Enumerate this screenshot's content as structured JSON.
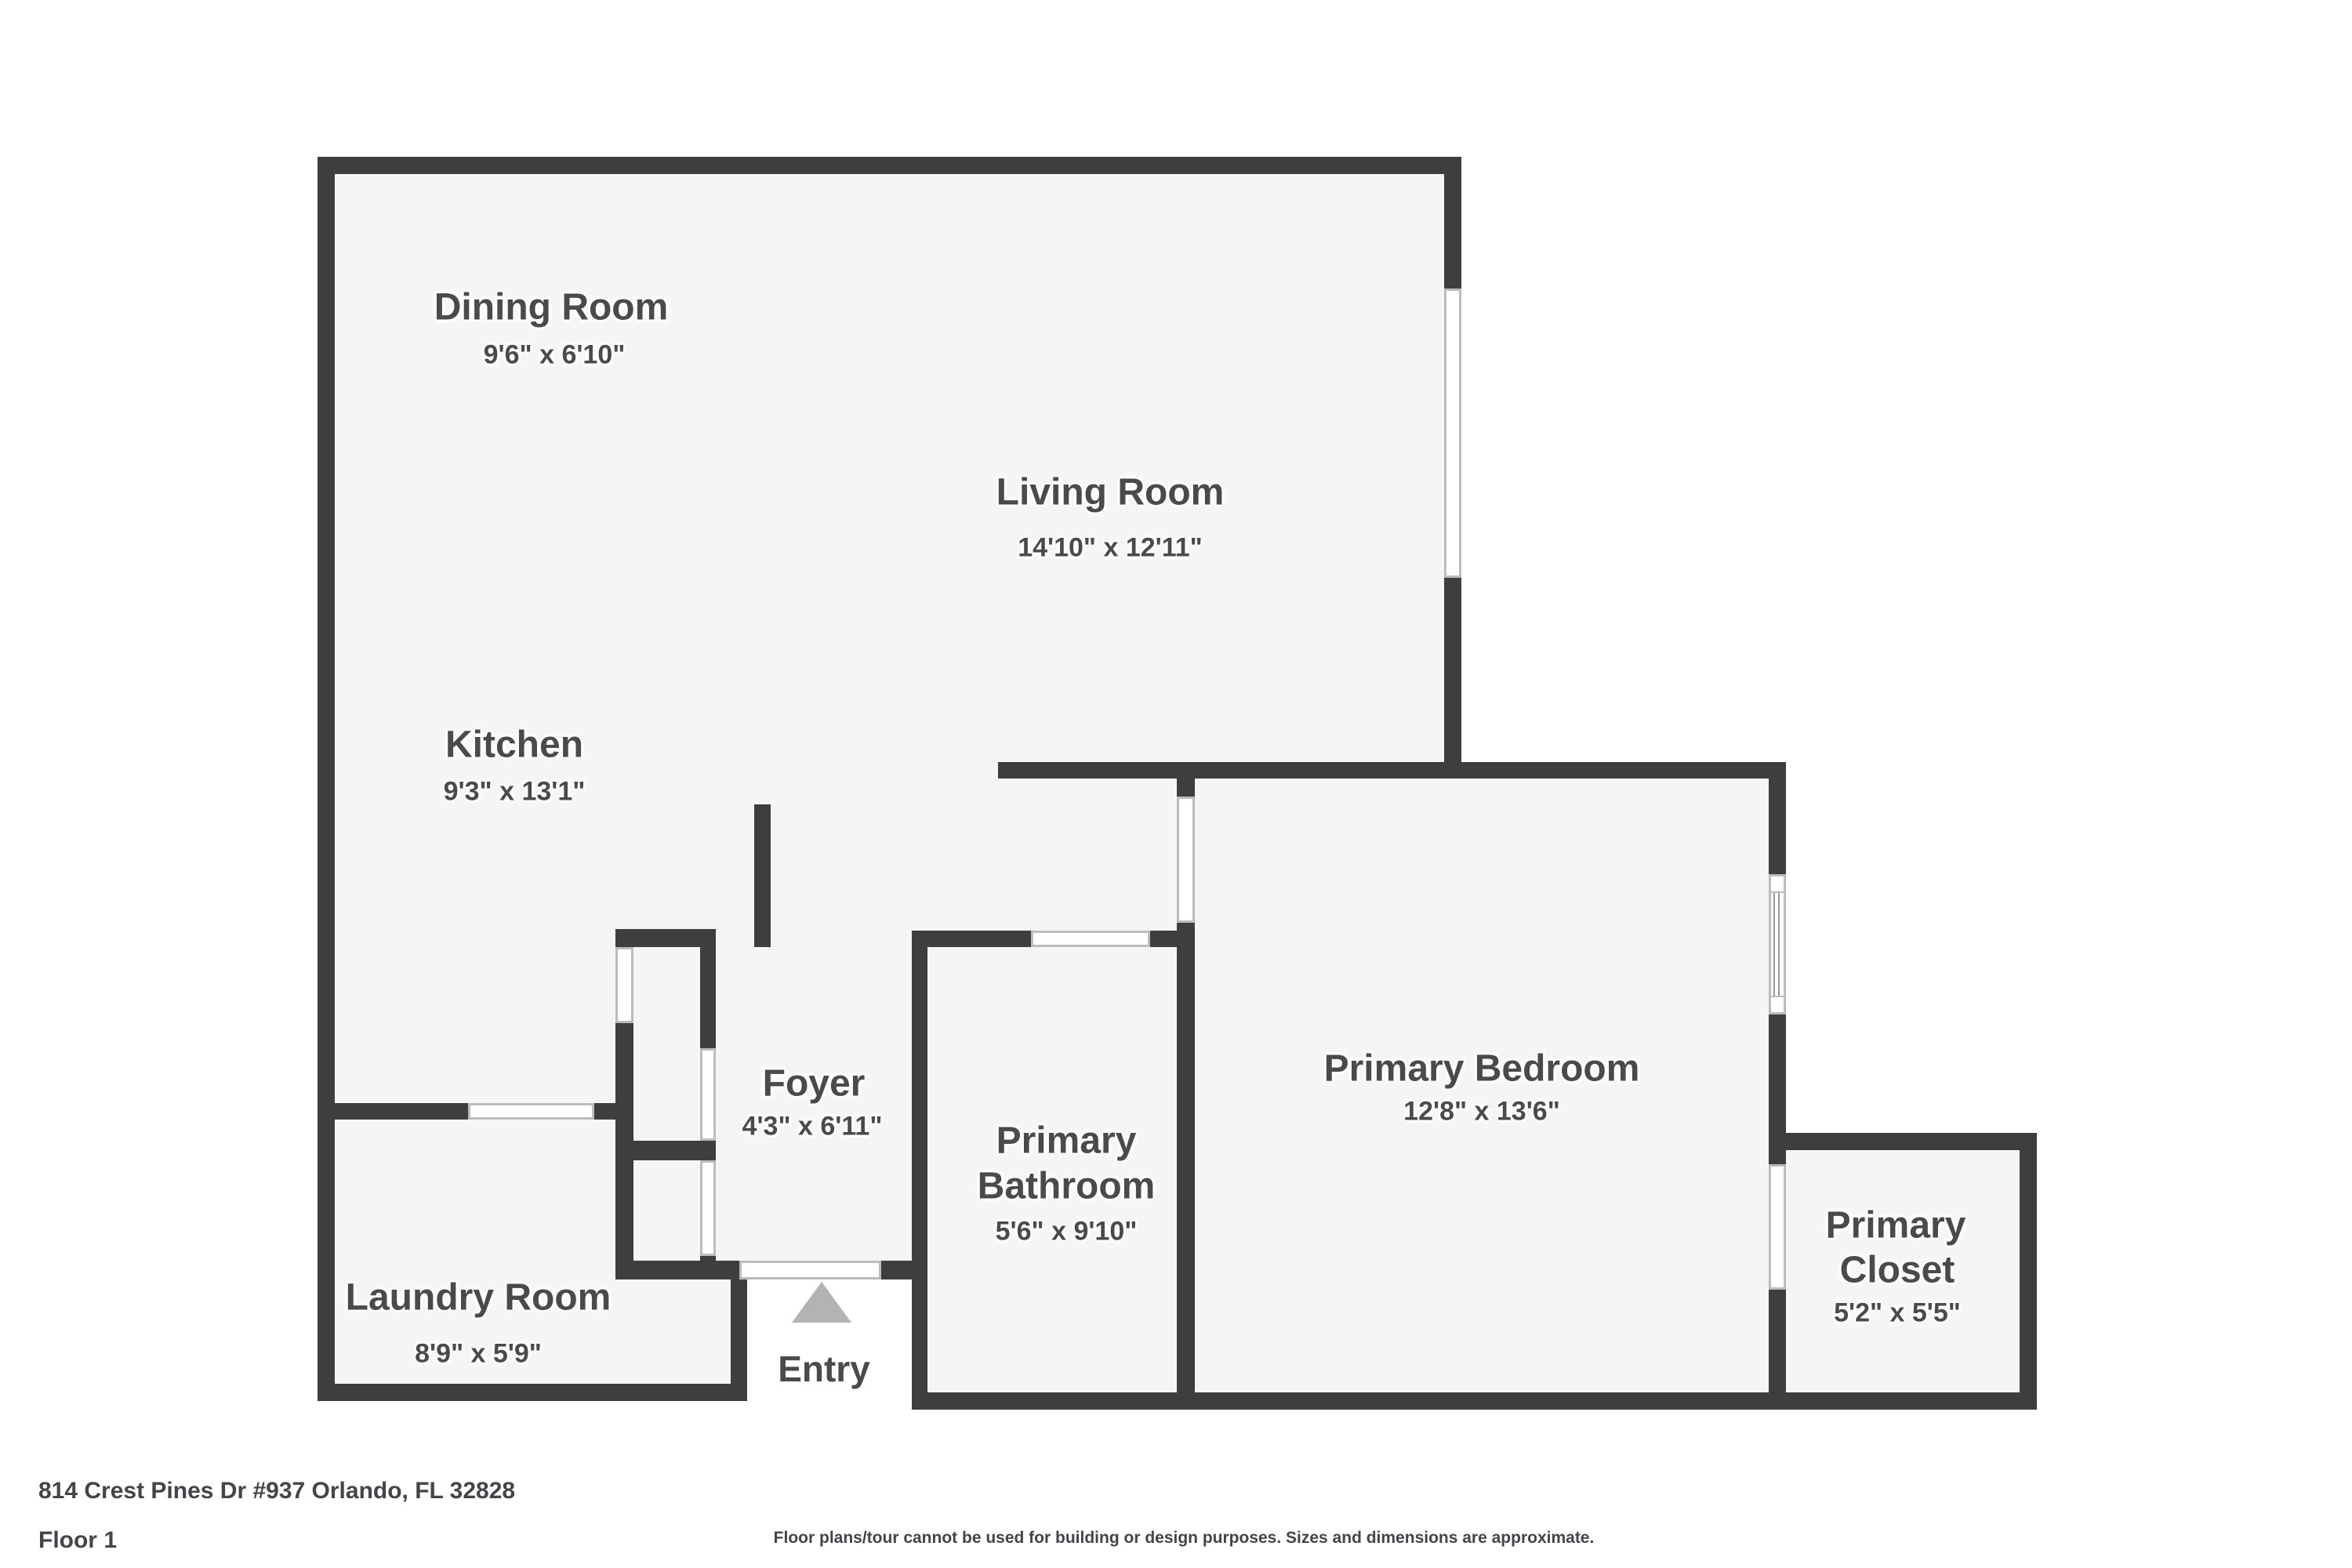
{
  "meta": {
    "type": "floor-plan",
    "colors": {
      "wall": "#3e3e40",
      "floor_fill": "#f5f5f5",
      "background": "#ffffff",
      "opening_outline": "#bcbcbc",
      "label_text": "#4a4a4d",
      "entry_arrow": "#b3b3b3"
    }
  },
  "rooms": {
    "dining": {
      "name": "Dining Room",
      "dims": "9'6\" x 6'10\""
    },
    "living": {
      "name": "Living Room",
      "dims": "14'10\" x 12'11\""
    },
    "kitchen": {
      "name": "Kitchen",
      "dims": "9'3\" x 13'1\""
    },
    "foyer": {
      "name": "Foyer",
      "dims": "4'3\" x 6'11\""
    },
    "laundry": {
      "name": "Laundry Room",
      "dims": "8'9\" x 5'9\""
    },
    "bathroom": {
      "name_line1": "Primary",
      "name_line2": "Bathroom",
      "dims": "5'6\" x 9'10\""
    },
    "bedroom": {
      "name": "Primary Bedroom",
      "dims": "12'8\" x 13'6\""
    },
    "closet": {
      "name_line1": "Primary",
      "name_line2": "Closet",
      "dims": "5'2\" x 5'5\""
    }
  },
  "entry": {
    "label": "Entry"
  },
  "footer": {
    "address": "814 Crest Pines Dr #937 Orlando, FL 32828",
    "floor": "Floor 1",
    "disclaimer": "Floor plans/tour cannot be used for building or design purposes. Sizes and dimensions are approximate."
  }
}
